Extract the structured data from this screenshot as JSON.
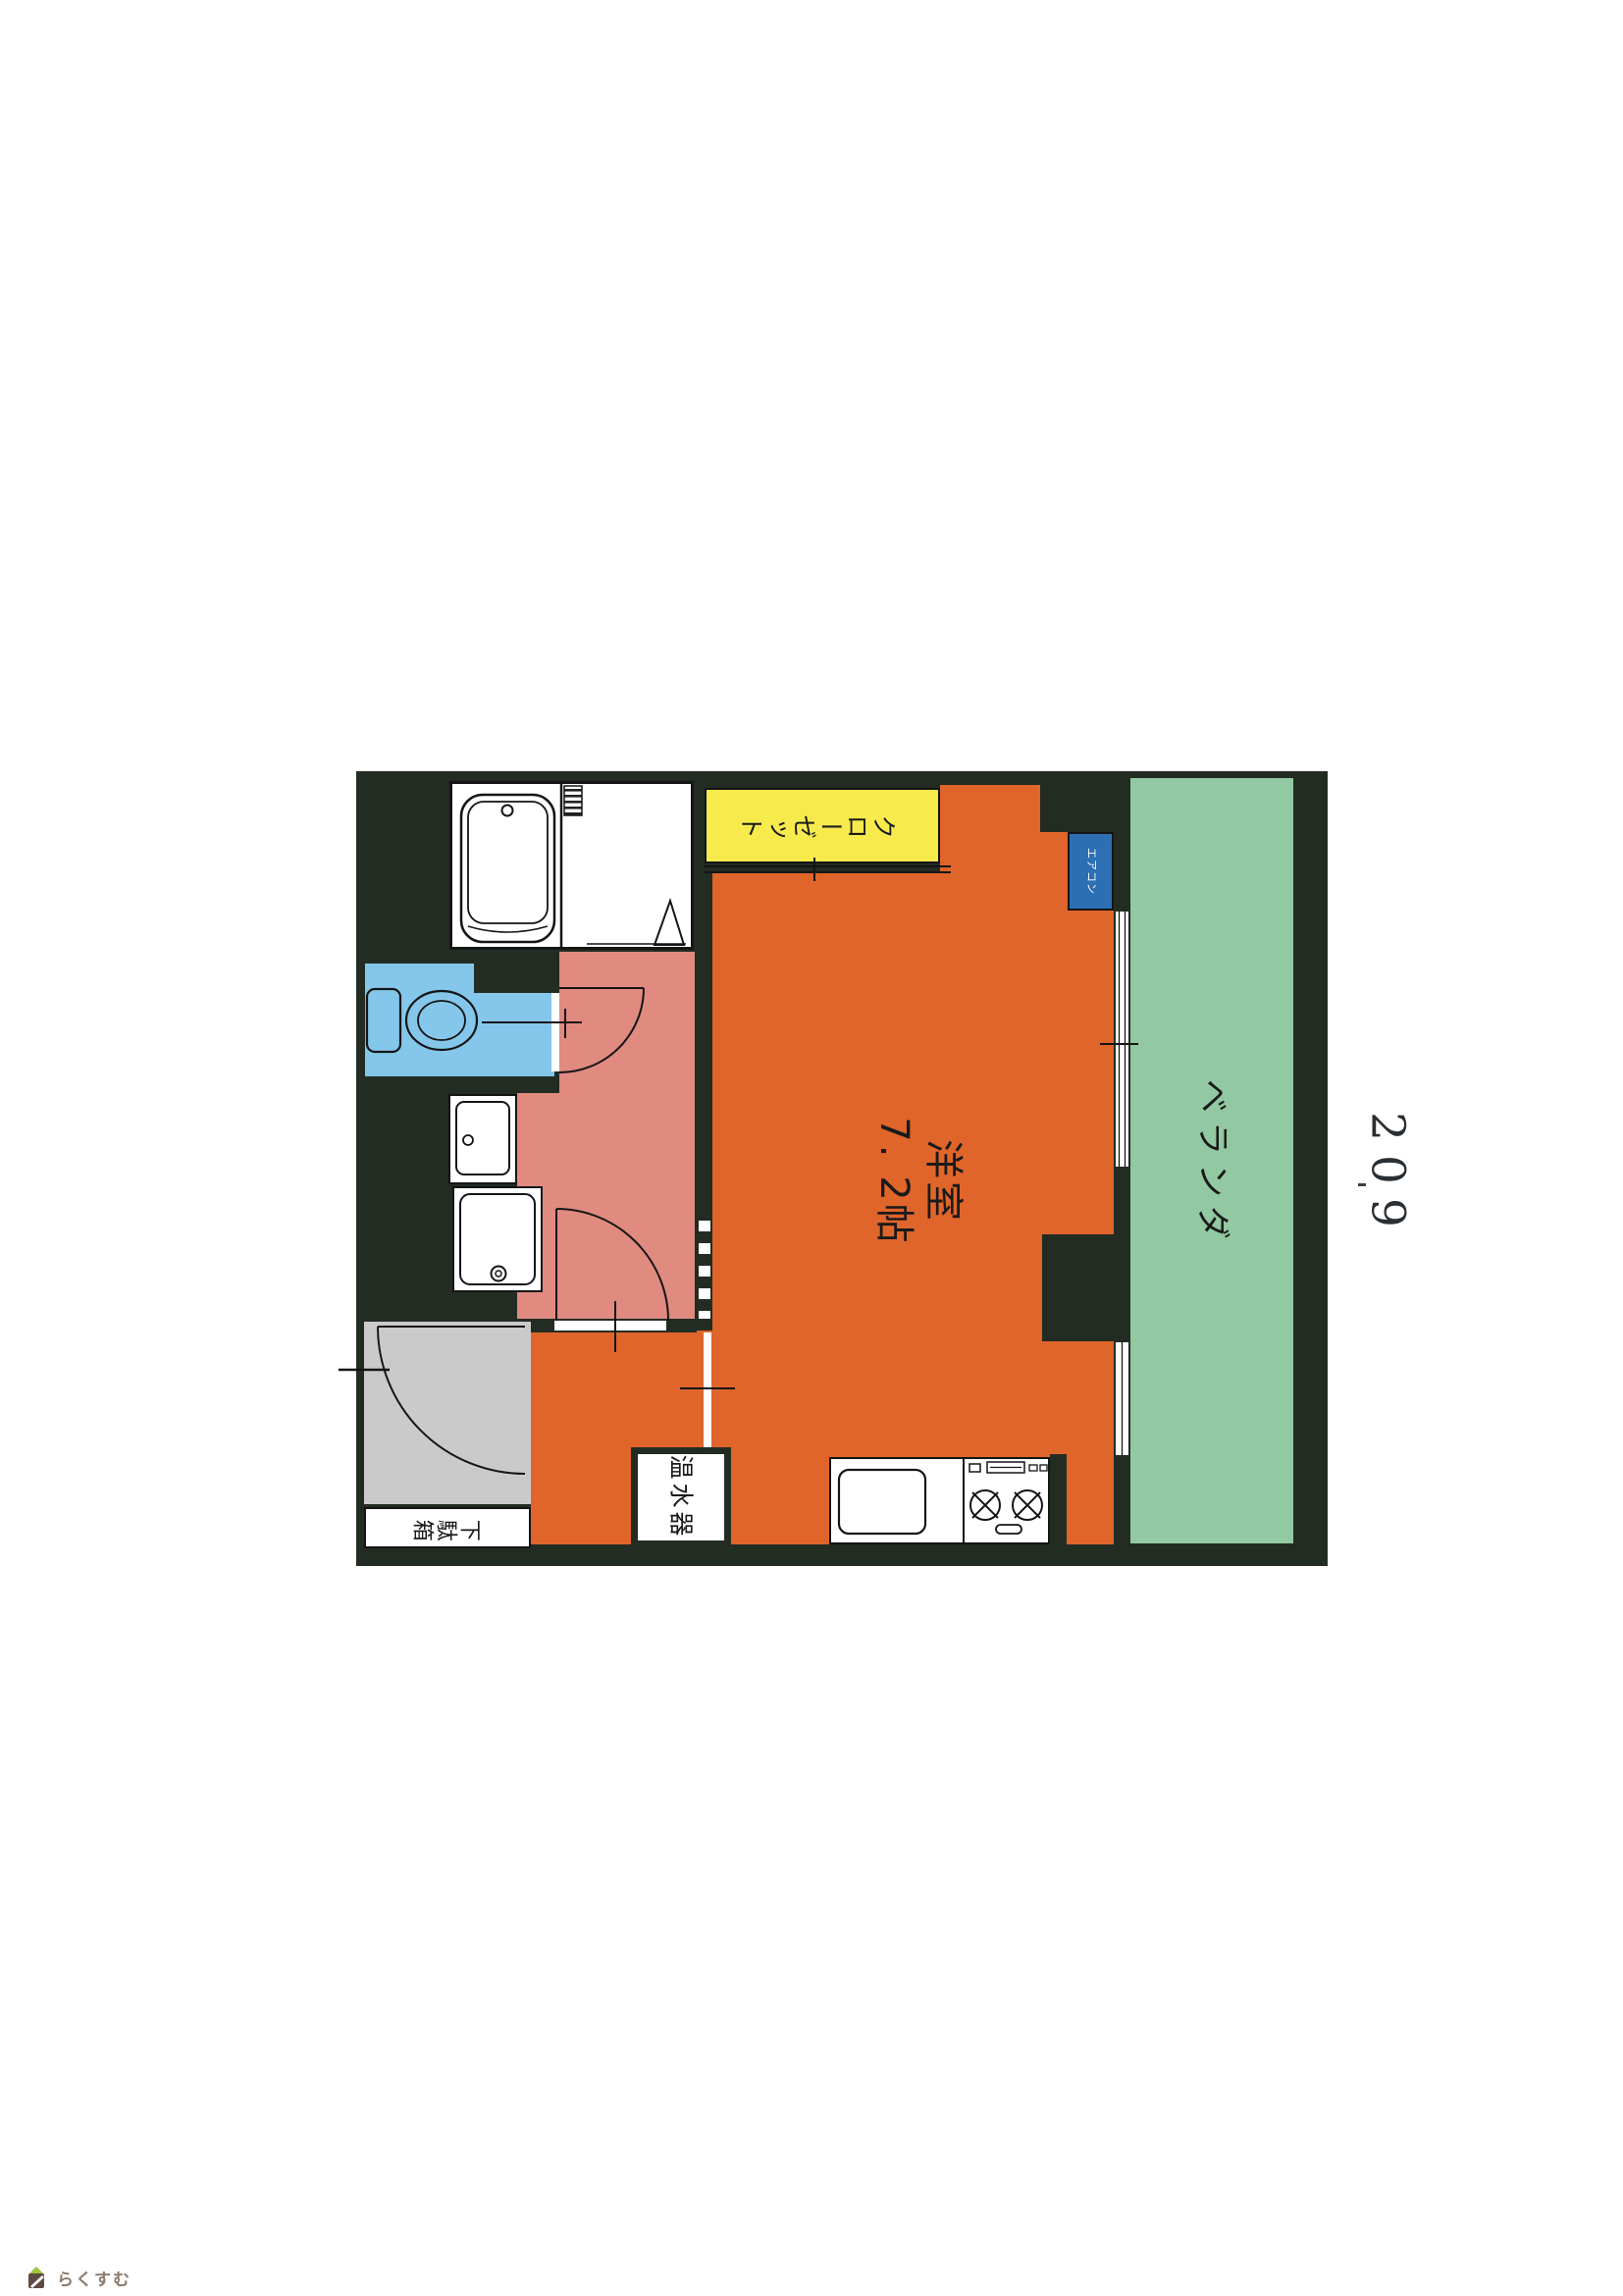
{
  "page": {
    "unit_number": "209",
    "logo_text": "らくすむ"
  },
  "floorplan": {
    "rooms": {
      "main_room": {
        "name": "洋室",
        "size": "7. 2帖"
      },
      "balcony": {
        "label": "ベランダ"
      },
      "closet": {
        "label": "クローゼット"
      },
      "aircon": {
        "label": "エアコン"
      },
      "water_heater": {
        "label": "温水器"
      },
      "shoe_box": {
        "label": "下駄箱"
      }
    },
    "colors": {
      "wall": "#232c23",
      "main_room": "#df652a",
      "hallway": "#e08a80",
      "toilet": "#84c7eb",
      "closet": "#f7ea4d",
      "balcony": "#92c9a2",
      "aircon_box": "#2d6fb3",
      "entrance": "#cacaca",
      "logo_roof": "#9ec43c",
      "logo_body": "#5c4b40"
    }
  }
}
